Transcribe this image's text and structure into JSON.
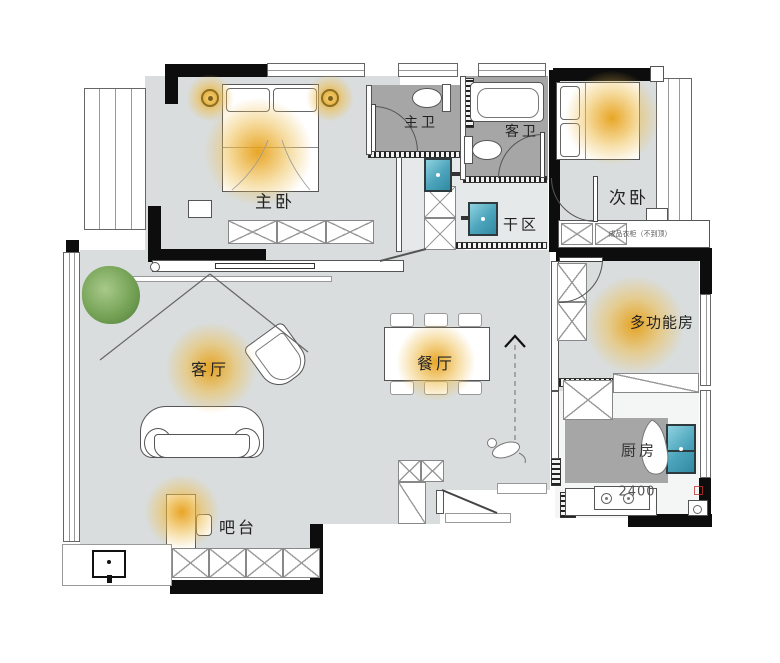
{
  "diagram": {
    "type": "apartment-floor-plan",
    "rooms": {
      "master_bedroom": {
        "label": "主卧"
      },
      "master_bath": {
        "label": "主卫"
      },
      "guest_bath": {
        "label": "客卫"
      },
      "second_bedroom": {
        "label": "次卧"
      },
      "dry_area": {
        "label": "干区"
      },
      "multi_room": {
        "label": "多功能房"
      },
      "kitchen": {
        "label": "厨房"
      },
      "dining": {
        "label": "餐厅"
      },
      "living": {
        "label": "客厅"
      },
      "bar": {
        "label": "吧台"
      }
    },
    "annotations": {
      "wardrobe_note": "成品衣柜（不到顶）",
      "kitchen_dimension": "2400"
    },
    "colors": {
      "floor": "#d9dddd",
      "corridor_floor": "#e6e9e9",
      "wet_area": "#a6a6a6",
      "wall": "#0d0d0d",
      "light_glow": "#e8a114",
      "basin": "#4aa3ba",
      "plant": "#75a356",
      "stamp_red": "#c2352b"
    }
  }
}
